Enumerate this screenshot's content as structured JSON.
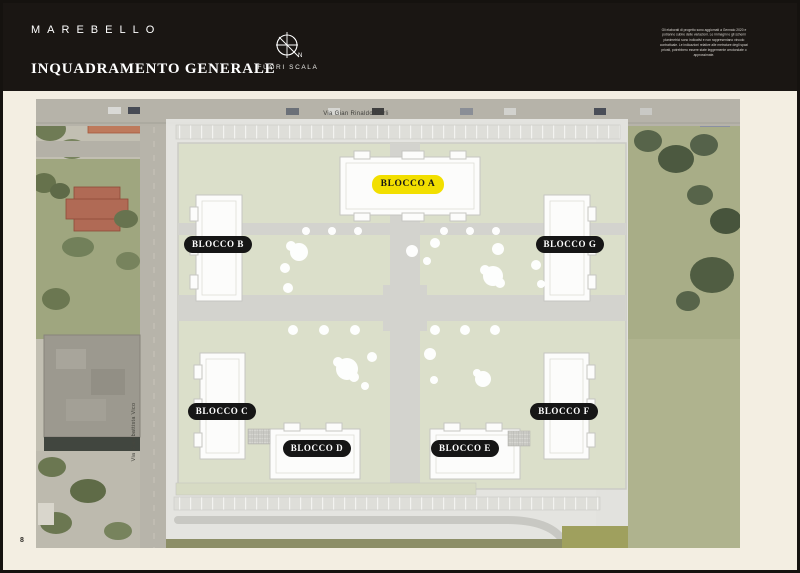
{
  "page": {
    "number": "8",
    "background": "#F3EEE2",
    "border_color": "#15120F"
  },
  "header": {
    "logo": "MAREBELLO",
    "title": "INQUADRAMENTO GENERALE",
    "compass_label": "N",
    "scale_note": "FUORI SCALA",
    "disclaimer": "Gli elaborati di progetto sono aggiornati a Gennaio 2020 e potranno subire delle variazioni. Le immagini e gli schemi planimetrici sono indicativi e non rappresentano vincolo contrattuale. Le indicazioni relative alle metrature degli spazi privati, potrebbero essere state leggermente arrotondate o approssimate.",
    "background": "#1A1613"
  },
  "map": {
    "type": "aerial-masterplan",
    "streets": [
      {
        "name": "Via Gian Rinaldo Carli",
        "orientation": "horizontal"
      },
      {
        "name": "Via Giambattista Vico",
        "orientation": "vertical"
      }
    ],
    "blocks": [
      {
        "id": "A",
        "label": "BLOCCO A",
        "highlighted": true
      },
      {
        "id": "B",
        "label": "BLOCCO B",
        "highlighted": false
      },
      {
        "id": "G",
        "label": "BLOCCO G",
        "highlighted": false
      },
      {
        "id": "C",
        "label": "BLOCCO C",
        "highlighted": false
      },
      {
        "id": "D",
        "label": "BLOCCO D",
        "highlighted": false
      },
      {
        "id": "E",
        "label": "BLOCCO E",
        "highlighted": false
      },
      {
        "id": "F",
        "label": "BLOCCO F",
        "highlighted": false
      }
    ],
    "colors": {
      "highlight_pill": "#F2DF00",
      "pill": "#161616",
      "pill_text": "#FFFFFF",
      "courtyard_green": "#DBDFCA",
      "plan_gray": "#E6E6E2"
    }
  }
}
